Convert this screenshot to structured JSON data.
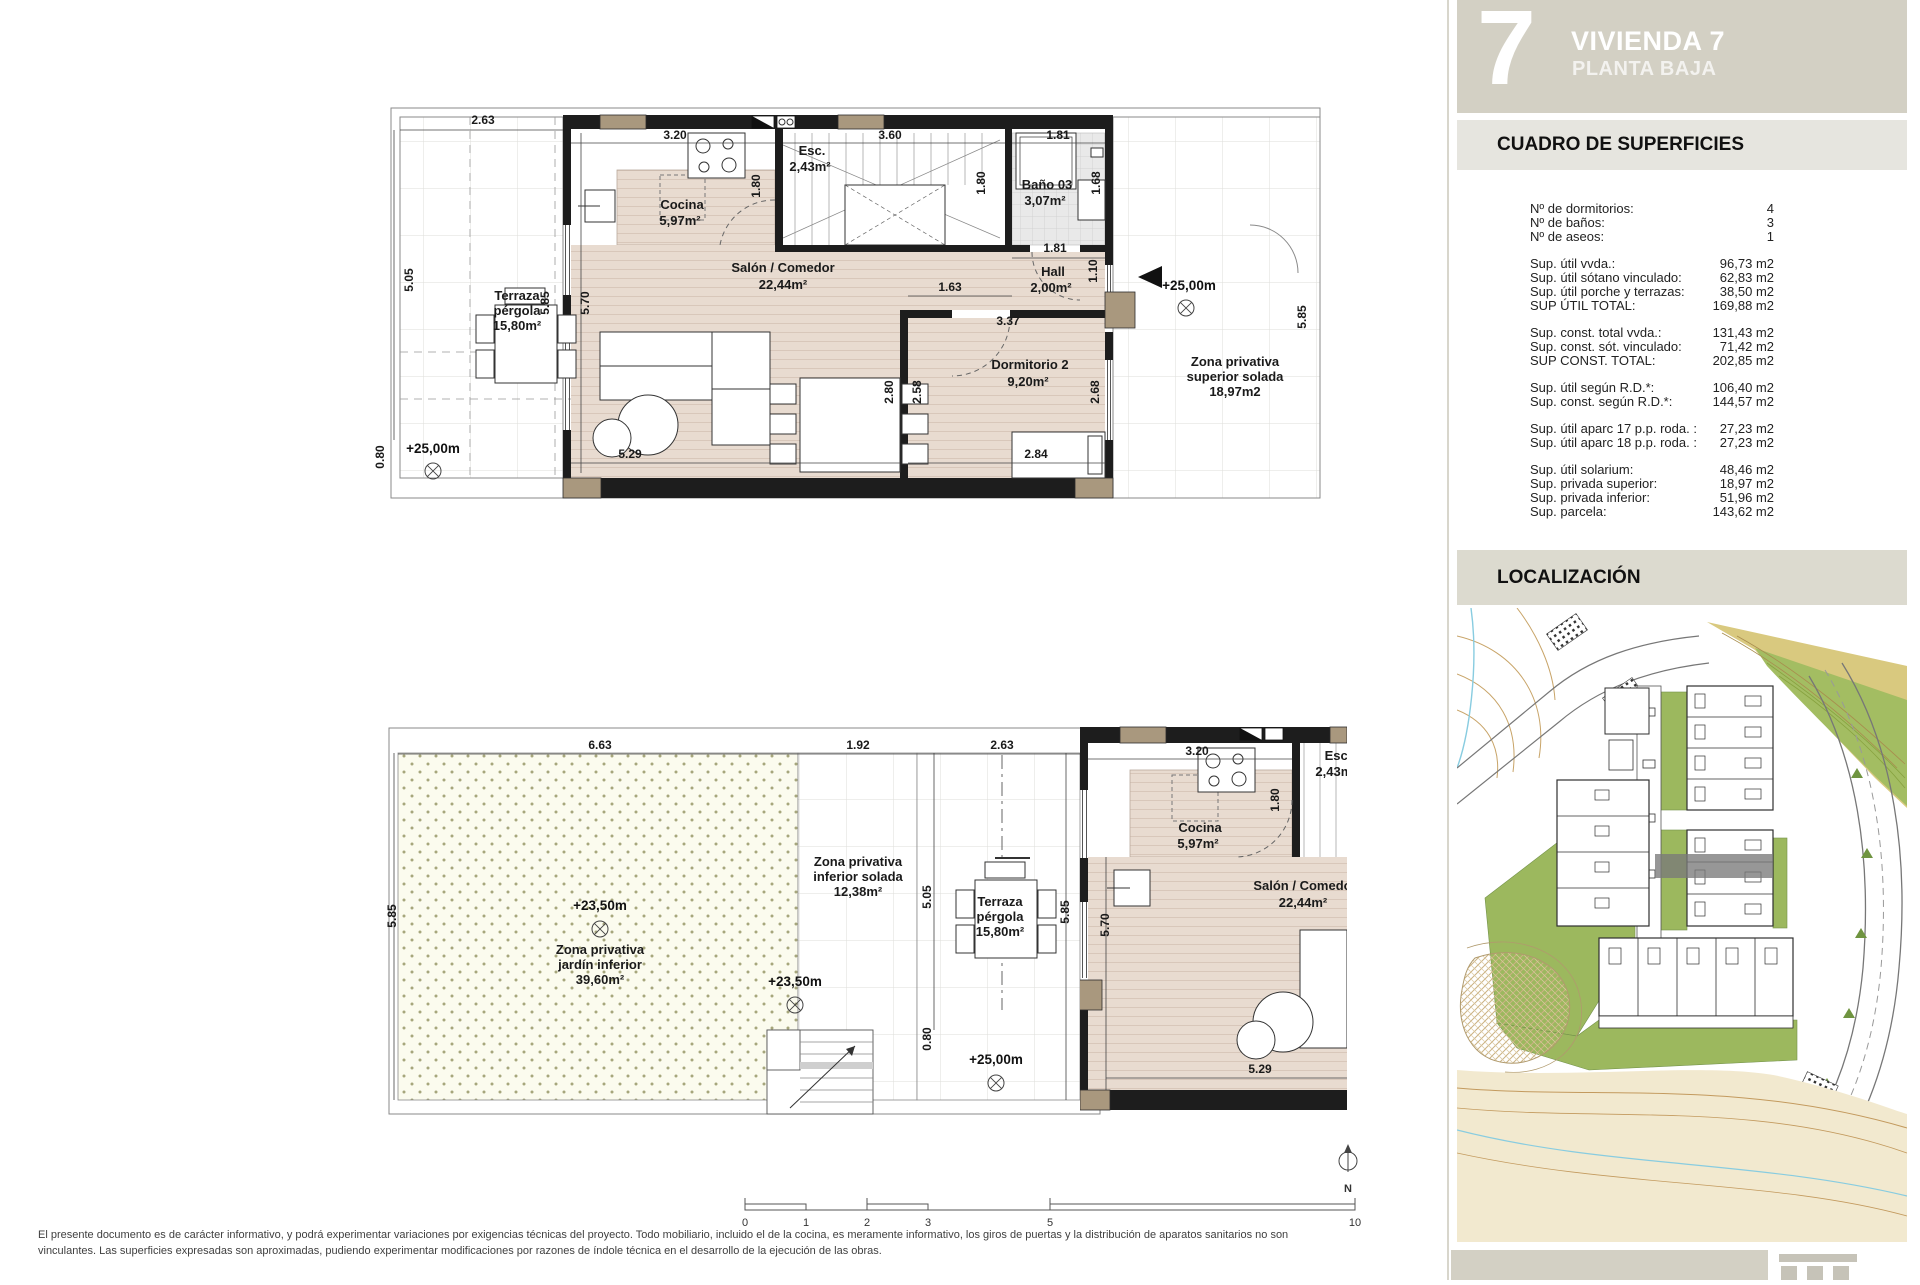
{
  "sidebar": {
    "unit_number": "7",
    "title": "VIVIENDA 7",
    "subtitle": "PLANTA BAJA",
    "surfaces_title": "CUADRO DE SUPERFICIES",
    "surface_groups": [
      {
        "rows": [
          {
            "label": "Nº de dormitorios:",
            "value": "4"
          },
          {
            "label": "Nº de baños:",
            "value": "3"
          },
          {
            "label": "Nº de aseos:",
            "value": "1"
          }
        ]
      },
      {
        "rows": [
          {
            "label": "Sup. útil vvda.:",
            "value": "96,73 m2"
          },
          {
            "label": "Sup. útil sótano vinculado:",
            "value": "62,83 m2"
          },
          {
            "label": "Sup. útil porche y terrazas:",
            "value": "38,50 m2"
          },
          {
            "label": "SUP ÚTIL TOTAL:",
            "value": "169,88 m2"
          }
        ]
      },
      {
        "rows": [
          {
            "label": "Sup. const. total vvda.:",
            "value": "131,43 m2"
          },
          {
            "label": "Sup. const. sót. vinculado:",
            "value": "71,42 m2"
          },
          {
            "label": "SUP CONST. TOTAL:",
            "value": "202,85 m2"
          }
        ]
      },
      {
        "rows": [
          {
            "label": "Sup. útil según R.D.*:",
            "value": "106,40 m2"
          },
          {
            "label": "Sup. const. según R.D.*:",
            "value": "144,57 m2"
          }
        ]
      },
      {
        "rows": [
          {
            "label": "Sup. útil aparc 17 p.p. roda. :",
            "value": "27,23 m2"
          },
          {
            "label": "Sup. útil aparc 18 p.p. roda. :",
            "value": "27,23 m2"
          }
        ]
      },
      {
        "rows": [
          {
            "label": "Sup. útil solarium:",
            "value": "48,46 m2"
          },
          {
            "label": "Sup. privada superior:",
            "value": "18,97 m2"
          },
          {
            "label": "Sup. privada inferior:",
            "value": "51,96 m2"
          },
          {
            "label": "Sup. parcela:",
            "value": "143,62 m2"
          }
        ]
      }
    ],
    "localization_title": "LOCALIZACIÓN"
  },
  "plan_labels": {
    "terraza_1": "Terraza",
    "terraza_2": "pérgola",
    "terraza_3": "15,80m²",
    "cocina_1": "Cocina",
    "cocina_2": "5,97m²",
    "salon_1": "Salón / Comedor",
    "salon_2": "22,44m²",
    "esc_1": "Esc.",
    "esc_2": "2,43m²",
    "bano_1": "Baño 03",
    "bano_2": "3,07m²",
    "hall_1": "Hall",
    "hall_2": "2,00m²",
    "dorm_1": "Dormitorio 2",
    "dorm_2": "9,20m²",
    "zona_sup_1": "Zona privativa",
    "zona_sup_2": "superior solada",
    "zona_sup_3": "18,97m2",
    "zona_jardin_1": "Zona privativa",
    "zona_jardin_2": "jardín inferior",
    "zona_jardin_3": "39,60m²",
    "zona_inf_1": "Zona privativa",
    "zona_inf_2": "inferior solada",
    "zona_inf_3": "12,38m²",
    "level_25": "+25,00m",
    "level_235": "+23,50m",
    "north": "N"
  },
  "dims": {
    "d080": "0.80",
    "d110": "1.10",
    "d163": "1.63",
    "d168": "1.68",
    "d180": "1.80",
    "d181": "1.81",
    "d192": "1.92",
    "d258": "2.58",
    "d263": "2.63",
    "d268": "2.68",
    "d280": "2.80",
    "d284": "2.84",
    "d320": "3.20",
    "d337": "3.37",
    "d360": "3.60",
    "d505": "5.05",
    "d529": "5.29",
    "d570": "5.70",
    "d585": "5.85",
    "d663": "6.63"
  },
  "scalebar": {
    "t0": "0",
    "t1": "1",
    "t2": "2",
    "t3": "3",
    "t5": "5",
    "t10": "10"
  },
  "disclaimer": {
    "line1": "El presente documento es de carácter informativo, y podrá experimentar variaciones por exigencias técnicas del proyecto. Todo mobiliario, incluido el de la cocina, es meramente informativo, los giros de puertas y la distribución de aparatos sanitarios no son",
    "line2": "vinculantes. Las superficies expresadas son aproximadas, pudiendo experimentar modificaciones por razones de índole técnica en el desarrollo de la ejecución de las obras."
  }
}
